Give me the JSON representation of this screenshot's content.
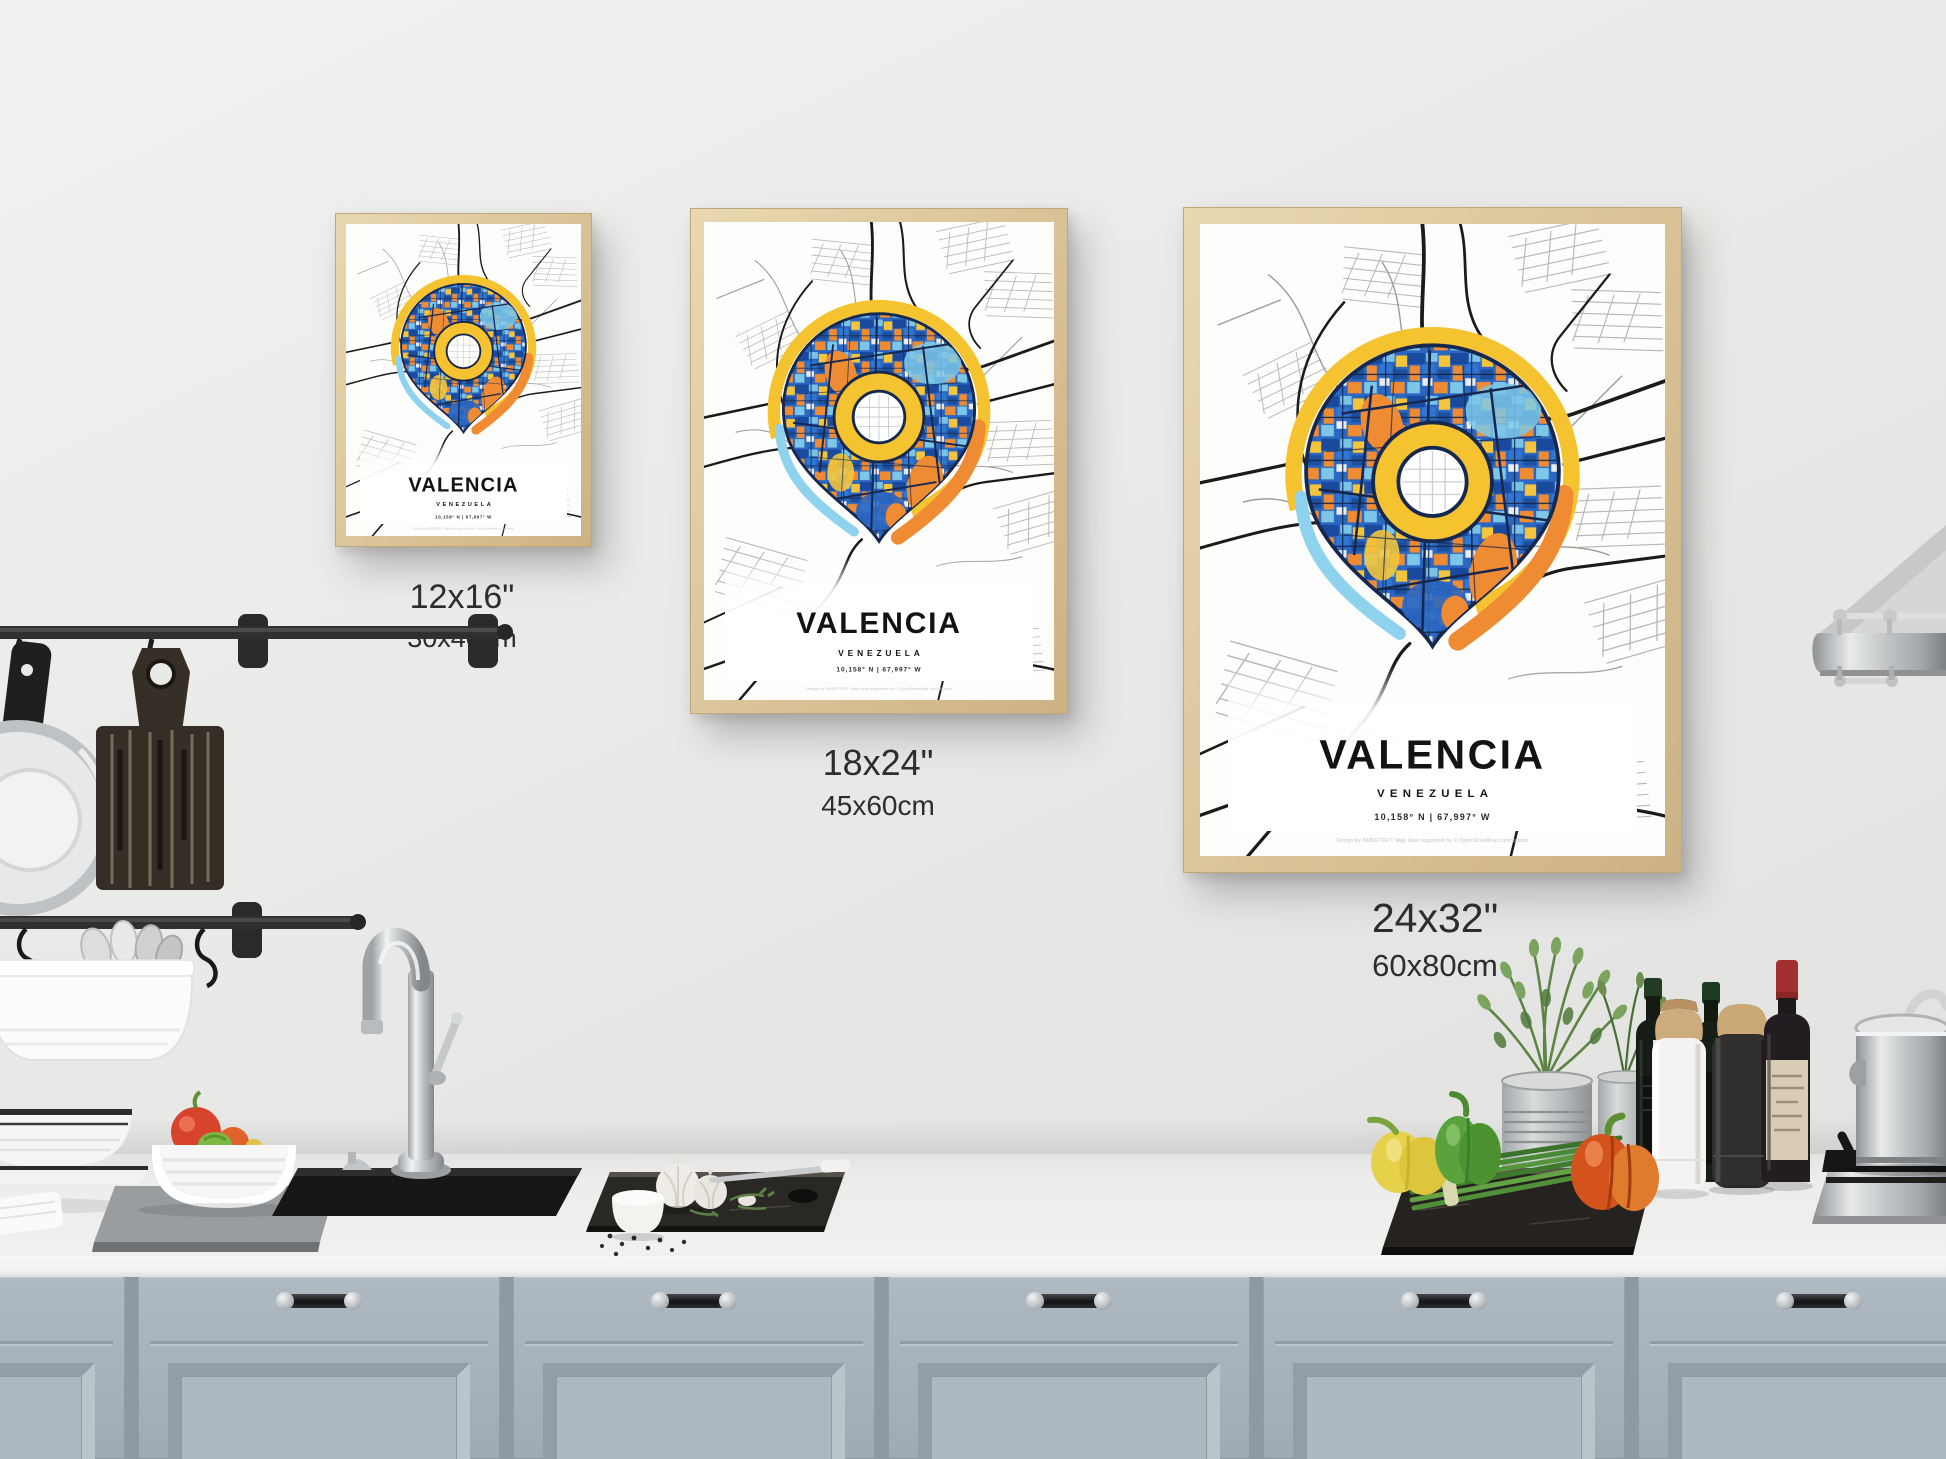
{
  "posters": [
    {
      "title": "VALENCIA",
      "subtitle": "VENEZUELA",
      "coordinates": "10,158° N | 67,997° W",
      "credit": "Design by HEBSTREIT. Map data supported by © OpenStreetMap contributors",
      "size_in": "12x16\"",
      "size_cm": "30x40cm"
    },
    {
      "title": "VALENCIA",
      "subtitle": "VENEZUELA",
      "coordinates": "10,158° N | 67,997° W",
      "credit": "Design by HEBSTREIT. Map data supported by © OpenStreetMap contributors",
      "size_in": "18x24\"",
      "size_cm": "45x60cm"
    },
    {
      "title": "VALENCIA",
      "subtitle": "VENEZUELA",
      "coordinates": "10,158° N | 67,997° W",
      "credit": "Design by HEBSTREIT. Map data supported by © OpenStreetMap contributors",
      "size_in": "24x32\"",
      "size_cm": "60x80cm"
    }
  ],
  "colors": {
    "wall": "#e9e9e8",
    "frame_wood": "#dcc69b",
    "cabinet_blue_gray": "#a6b2bb",
    "counter_white": "#efefed",
    "pin_blue": "#2b66c0",
    "pin_light_blue": "#7cc7e8",
    "pin_yellow": "#f5c330",
    "pin_orange": "#ef8b33",
    "pin_outline": "#16284e",
    "poster_text": "#131313",
    "size_label_text": "#2d2d2d"
  }
}
